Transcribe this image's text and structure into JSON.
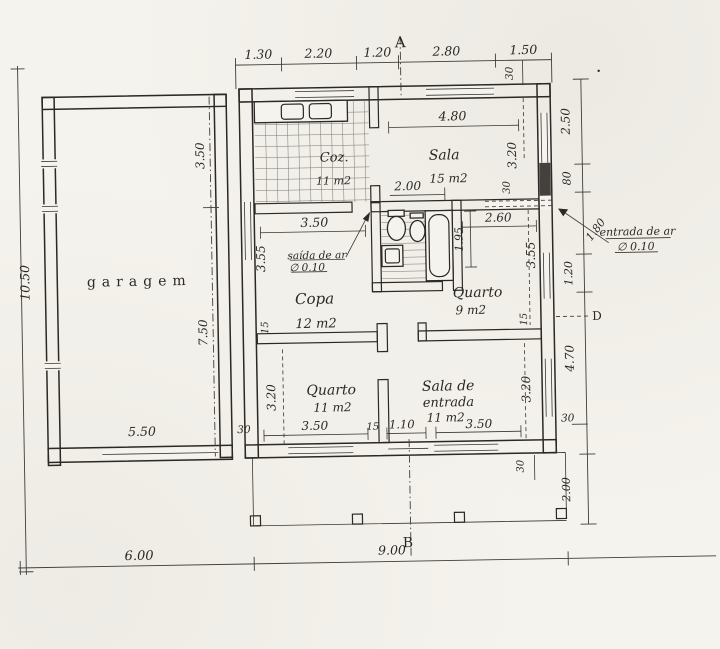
{
  "page": {
    "paper_color": "#f5f3ed",
    "ink_color": "#2b2826",
    "type": "hand-drawn floor plan"
  },
  "rooms": {
    "garagem": {
      "label": "garagem"
    },
    "cozinha": {
      "label": "Coz.",
      "area": "11 m2"
    },
    "sala": {
      "label": "Sala",
      "area": "15 m2"
    },
    "copa": {
      "label": "Copa",
      "area": "12 m2"
    },
    "quarto_9": {
      "label": "Quarto",
      "area": "9 m2"
    },
    "quarto_11": {
      "label": "Quarto",
      "area": "11 m2"
    },
    "sala_entrada": {
      "label1": "Sala de",
      "label2": "entrada",
      "area": "11 m2"
    }
  },
  "sections": {
    "a": "A",
    "b": "B",
    "d": "D"
  },
  "annotations": {
    "air_outlet_line1": "saída de ar",
    "air_outlet_line2": "∅ 0.10",
    "air_inlet_line1": "entrada de ar",
    "air_inlet_line2": "∅ 0.10"
  },
  "dims": {
    "top": [
      "1.30",
      "2.20",
      "1.20",
      "2.80",
      "1.50"
    ],
    "top_wall": "30",
    "right": {
      "r1": "2.50",
      "r2": "80",
      "r3": "1.80",
      "r4": "1.20",
      "r5": "4.70",
      "r6": "30",
      "r7": "2.00"
    },
    "left_height": "10.50",
    "garage": {
      "upper": "3.50",
      "lower": "7.50",
      "width": "5.50",
      "gap": "30"
    },
    "sala": {
      "width": "4.80",
      "opening": "2.00",
      "height": "3.20",
      "wall": "30"
    },
    "copa": {
      "width": "3.50",
      "height": "3.55",
      "wall": "15"
    },
    "quarto9": {
      "width": "2.60",
      "bath_len": "1.95",
      "height": "3.55",
      "wall": "15"
    },
    "quarto11": {
      "width": "3.50",
      "height": "3.20",
      "wall": "15"
    },
    "front_door": "1.10",
    "entrada": {
      "width": "3.50",
      "height": "3.20"
    },
    "porch_wall": "30",
    "bottom": {
      "garage": "6.00",
      "house": "9.00"
    }
  }
}
